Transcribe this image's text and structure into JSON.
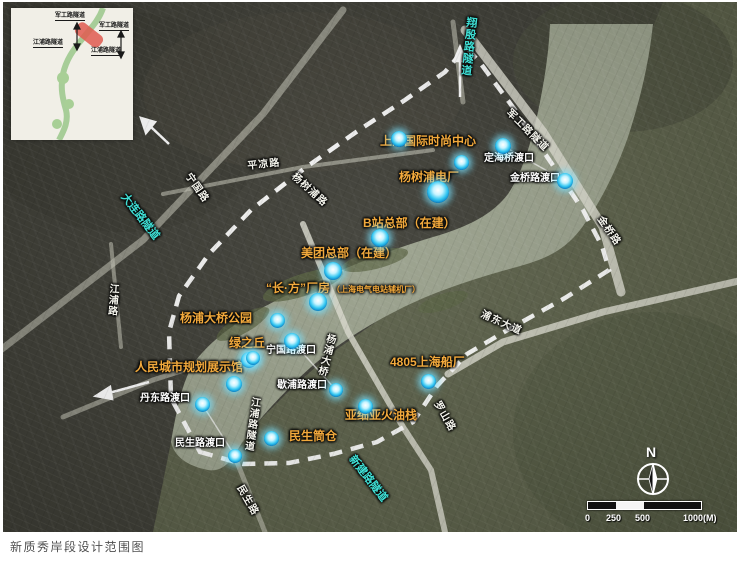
{
  "caption": "新质秀岸段设计范围图",
  "inset": {
    "labels": [
      "军工路隧道",
      "军工路隧道",
      "江浦路隧道",
      "江浦路隧道"
    ]
  },
  "compass": {
    "north": "N"
  },
  "scale_bar": {
    "ticks": [
      "0",
      "250",
      "500"
    ],
    "end": "1000(M)"
  },
  "colors": {
    "poi": "#f2a93c",
    "ferry": "#ffffff",
    "road": "#f4f4ec",
    "tunnel": "#3fe0d6",
    "water": "#9aa18c",
    "puxi": "#3e3e36",
    "pudong": "#5b6049",
    "boundary": "#ffffff",
    "marker_core": "#35c8f2",
    "inset_highlight": "#e05a50"
  },
  "labels": [
    {
      "text": "上海国际时尚中心",
      "x": 377,
      "y": 133,
      "rot": 0,
      "cls": "poi",
      "name": "label-shanghai-international-fashion-center"
    },
    {
      "text": "杨树浦电厂",
      "x": 396,
      "y": 169,
      "rot": 0,
      "cls": "poi",
      "name": "label-yangshupu-power-plant"
    },
    {
      "text": "B站总部（在建）",
      "x": 360,
      "y": 215,
      "rot": 0,
      "cls": "poi",
      "name": "label-bilibili-hq-under-construction"
    },
    {
      "text": "美团总部（在建）",
      "x": 298,
      "y": 245,
      "rot": 0,
      "cls": "poi",
      "name": "label-meituan-hq-under-construction"
    },
    {
      "text": "“长·方”厂房",
      "x": 263,
      "y": 280,
      "rot": 0,
      "cls": "poi",
      "name": "label-changfang-factory",
      "suffix": "（上海电气电站辅机厂）"
    },
    {
      "text": "杨浦大桥公园",
      "x": 177,
      "y": 310,
      "rot": 0,
      "cls": "poi",
      "name": "label-yangpu-bridge-park"
    },
    {
      "text": "绿之丘",
      "x": 226,
      "y": 335,
      "rot": 0,
      "cls": "poi",
      "name": "label-green-hill"
    },
    {
      "text": "人民城市规划展示馆",
      "x": 132,
      "y": 359,
      "rot": 0,
      "cls": "poi",
      "name": "label-people-city-planning-exhibition-hall"
    },
    {
      "text": "4805上海船厂",
      "x": 387,
      "y": 354,
      "rot": 0,
      "cls": "poi",
      "name": "label-4805-shanghai-shipyard"
    },
    {
      "text": "亚细亚火油栈",
      "x": 342,
      "y": 407,
      "rot": 0,
      "cls": "poi",
      "name": "label-asiatic-petroleum-warehouse"
    },
    {
      "text": "民生筒仓",
      "x": 286,
      "y": 428,
      "rot": 0,
      "cls": "poi",
      "name": "label-minsheng-silo"
    },
    {
      "text": "定海桥渡口",
      "x": 481,
      "y": 152,
      "rot": 0,
      "cls": "ferry",
      "name": "label-dinghaiqiao-ferry"
    },
    {
      "text": "金桥路渡口",
      "x": 507,
      "y": 172,
      "rot": 0,
      "cls": "ferry",
      "name": "label-jinqiao-road-ferry"
    },
    {
      "text": "宁国路渡口",
      "x": 263,
      "y": 344,
      "rot": 0,
      "cls": "ferry",
      "name": "label-ningguo-road-ferry"
    },
    {
      "text": "歇浦路渡口",
      "x": 274,
      "y": 379,
      "rot": 0,
      "cls": "ferry",
      "name": "label-xiepu-road-ferry"
    },
    {
      "text": "丹东路渡口",
      "x": 137,
      "y": 392,
      "rot": 0,
      "cls": "ferry",
      "name": "label-dandong-road-ferry"
    },
    {
      "text": "民生路渡口",
      "x": 172,
      "y": 437,
      "rot": 0,
      "cls": "ferry",
      "name": "label-minsheng-road-ferry"
    },
    {
      "text": "平凉路",
      "x": 244,
      "y": 160,
      "rot": -6,
      "cls": "road",
      "name": "label-pingliang-road"
    },
    {
      "text": "宁国路",
      "x": 188,
      "y": 170,
      "rot": 55,
      "cls": "road",
      "name": "label-ningguo-road"
    },
    {
      "text": "杨树浦路",
      "x": 293,
      "y": 170,
      "rot": 42,
      "cls": "road",
      "name": "label-yangshupu-road"
    },
    {
      "text": "江浦路",
      "x": 104,
      "y": 281,
      "rot": 4,
      "cls": "road",
      "vert": true,
      "name": "label-jiangpu-road"
    },
    {
      "text": "金桥路",
      "x": 600,
      "y": 213,
      "rot": 55,
      "cls": "road",
      "name": "label-jinqiao-road"
    },
    {
      "text": "浦东大道",
      "x": 480,
      "y": 308,
      "rot": 24,
      "cls": "road",
      "name": "label-pudong-avenue"
    },
    {
      "text": "杨浦大桥",
      "x": 322,
      "y": 330,
      "rot": 14,
      "cls": "road",
      "vert": true,
      "name": "label-yangpu-bridge"
    },
    {
      "text": "军工路隧道",
      "x": 508,
      "y": 106,
      "rot": 45,
      "cls": "road",
      "name": "label-jungong-road-tunnel"
    },
    {
      "text": "江浦路隧道",
      "x": 246,
      "y": 394,
      "rot": 8,
      "cls": "road",
      "vert": true,
      "name": "label-jiangpu-road-tunnel"
    },
    {
      "text": "民生路",
      "x": 240,
      "y": 482,
      "rot": 60,
      "cls": "road",
      "name": "label-minsheng-road"
    },
    {
      "text": "罗山路",
      "x": 437,
      "y": 398,
      "rot": 60,
      "cls": "road",
      "name": "label-luoshan-road"
    },
    {
      "text": "翔殷路隧道",
      "x": 462,
      "y": 14,
      "rot": 6,
      "cls": "tun",
      "vert": true,
      "name": "label-xiangyin-road-tunnel"
    },
    {
      "text": "大连路隧道",
      "x": 124,
      "y": 190,
      "rot": 52,
      "cls": "tun",
      "name": "label-dalian-road-tunnel"
    },
    {
      "text": "新建路隧道",
      "x": 352,
      "y": 452,
      "rot": 52,
      "cls": "tun",
      "name": "label-xinjian-road-tunnel"
    }
  ],
  "markers": [
    [
      396,
      137,
      16
    ],
    [
      458,
      160,
      15
    ],
    [
      500,
      144,
      16
    ],
    [
      562,
      179,
      16
    ],
    [
      435,
      190,
      22
    ],
    [
      377,
      236,
      18
    ],
    [
      330,
      269,
      18
    ],
    [
      315,
      300,
      18
    ],
    [
      274,
      318,
      15
    ],
    [
      289,
      339,
      16
    ],
    [
      246,
      358,
      16
    ],
    [
      231,
      382,
      16
    ],
    [
      199,
      402,
      15
    ],
    [
      250,
      356,
      14
    ],
    [
      333,
      388,
      14
    ],
    [
      362,
      404,
      15
    ],
    [
      425,
      379,
      15
    ],
    [
      268,
      436,
      15
    ],
    [
      232,
      454,
      14
    ]
  ]
}
